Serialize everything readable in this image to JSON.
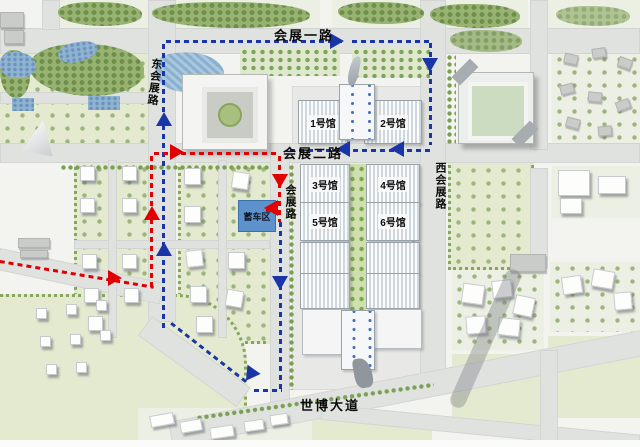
{
  "map": {
    "roads": [
      {
        "label": "会展一路",
        "orientation": "horizontal"
      },
      {
        "label": "会展二路",
        "orientation": "horizontal"
      },
      {
        "label": "东会展路",
        "orientation": "vertical"
      },
      {
        "label": "西会展路",
        "orientation": "vertical"
      },
      {
        "label": "会展路",
        "orientation": "vertical"
      },
      {
        "label": "世博大道",
        "orientation": "horizontal"
      }
    ],
    "halls": [
      {
        "label": "1号馆"
      },
      {
        "label": "2号馆"
      },
      {
        "label": "3号馆"
      },
      {
        "label": "4号馆"
      },
      {
        "label": "5号馆"
      },
      {
        "label": "6号馆"
      }
    ],
    "parking_zone": {
      "label": "蓄车区",
      "fill": "#5e92cc"
    },
    "routes": {
      "blue": {
        "color": "#1a35a8",
        "line_style": "dashed"
      },
      "red": {
        "color": "#e00000",
        "line_style": "dashed"
      }
    },
    "palette": {
      "road": "#e0e2df",
      "park_green": "#e3ead0",
      "dense_tree": "#97b271",
      "water": "#8fb3d2",
      "platform": "#e8e9e7",
      "hall_roof_stripe": "#cfd6dc"
    }
  }
}
